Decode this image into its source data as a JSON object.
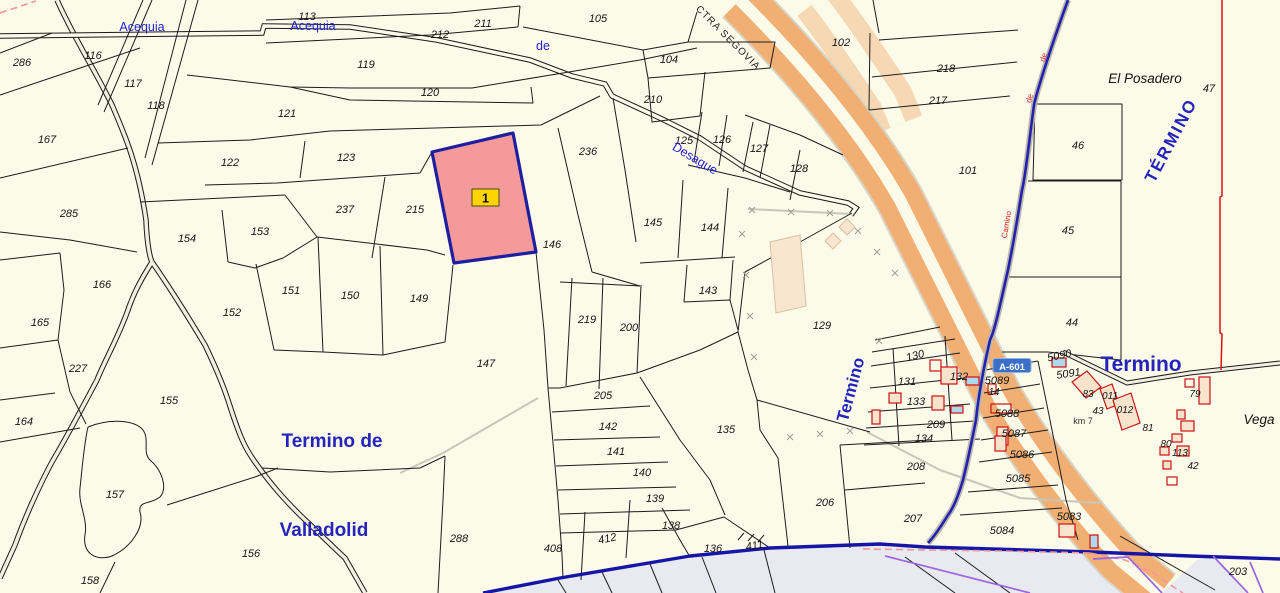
{
  "map": {
    "colors": {
      "background": "#FCFAE9",
      "highlight_fill": "#F59A9A",
      "highlight_border": "#1E1EA0",
      "badge_bg": "#FFD400",
      "highway_orange": "#F2AF74",
      "highway_ramp": "#F7D8B4",
      "canal_blue": "#2222AE",
      "boundary_blue": "#1616A6",
      "red_line": "#E01212",
      "purple_line": "#9A66E0",
      "pink_dash": "#F29898",
      "building_red": "#CC1111",
      "building_peach": "#F8E3CC",
      "building_blue": "#AFD8EC",
      "gray_area": "#E9EAF1"
    },
    "highlighted_parcel": {
      "badge": "1",
      "underlying_number": "214"
    },
    "road_shield": {
      "t": "A-601",
      "x": 1012,
      "y": 369
    },
    "parcel_numbers": [
      {
        "t": "286",
        "x": 22,
        "y": 62
      },
      {
        "t": "116",
        "x": 93,
        "y": 55
      },
      {
        "t": "117",
        "x": 133,
        "y": 83
      },
      {
        "t": "118",
        "x": 156,
        "y": 105
      },
      {
        "t": "167",
        "x": 47,
        "y": 139
      },
      {
        "t": "113",
        "x": 307,
        "y": 16
      },
      {
        "t": "211",
        "x": 483,
        "y": 23
      },
      {
        "t": "212",
        "x": 440,
        "y": 34
      },
      {
        "t": "105",
        "x": 598,
        "y": 18
      },
      {
        "t": "104",
        "x": 669,
        "y": 59
      },
      {
        "t": "210",
        "x": 653,
        "y": 99
      },
      {
        "t": "102",
        "x": 841,
        "y": 42
      },
      {
        "t": "218",
        "x": 946,
        "y": 68
      },
      {
        "t": "217",
        "x": 938,
        "y": 100
      },
      {
        "t": "101",
        "x": 968,
        "y": 170
      },
      {
        "t": "46",
        "x": 1078,
        "y": 145
      },
      {
        "t": "47",
        "x": 1209,
        "y": 88
      },
      {
        "t": "119",
        "x": 366,
        "y": 64
      },
      {
        "t": "120",
        "x": 430,
        "y": 92
      },
      {
        "t": "121",
        "x": 287,
        "y": 113
      },
      {
        "t": "122",
        "x": 230,
        "y": 162
      },
      {
        "t": "123",
        "x": 346,
        "y": 157
      },
      {
        "t": "237",
        "x": 345,
        "y": 209
      },
      {
        "t": "215",
        "x": 415,
        "y": 209
      },
      {
        "t": "236",
        "x": 588,
        "y": 151
      },
      {
        "t": "125",
        "x": 684,
        "y": 140
      },
      {
        "t": "126",
        "x": 722,
        "y": 139
      },
      {
        "t": "127",
        "x": 759,
        "y": 148
      },
      {
        "t": "128",
        "x": 799,
        "y": 168
      },
      {
        "t": "285",
        "x": 69,
        "y": 213
      },
      {
        "t": "154",
        "x": 187,
        "y": 238
      },
      {
        "t": "153",
        "x": 260,
        "y": 231
      },
      {
        "t": "145",
        "x": 653,
        "y": 222
      },
      {
        "t": "144",
        "x": 710,
        "y": 227
      },
      {
        "t": "146",
        "x": 552,
        "y": 244
      },
      {
        "t": "166",
        "x": 102,
        "y": 284
      },
      {
        "t": "165",
        "x": 40,
        "y": 322
      },
      {
        "t": "152",
        "x": 232,
        "y": 312
      },
      {
        "t": "151",
        "x": 291,
        "y": 290
      },
      {
        "t": "150",
        "x": 350,
        "y": 295
      },
      {
        "t": "149",
        "x": 419,
        "y": 298
      },
      {
        "t": "227",
        "x": 78,
        "y": 368
      },
      {
        "t": "219",
        "x": 587,
        "y": 319
      },
      {
        "t": "200",
        "x": 629,
        "y": 327
      },
      {
        "t": "143",
        "x": 708,
        "y": 290
      },
      {
        "t": "129",
        "x": 822,
        "y": 325
      },
      {
        "t": "45",
        "x": 1068,
        "y": 230
      },
      {
        "t": "44",
        "x": 1072,
        "y": 322
      },
      {
        "t": "147",
        "x": 486,
        "y": 363
      },
      {
        "t": "205",
        "x": 603,
        "y": 395
      },
      {
        "t": "142",
        "x": 608,
        "y": 426
      },
      {
        "t": "141",
        "x": 616,
        "y": 451
      },
      {
        "t": "140",
        "x": 642,
        "y": 472
      },
      {
        "t": "139",
        "x": 655,
        "y": 498
      },
      {
        "t": "138",
        "x": 671,
        "y": 525
      },
      {
        "t": "135",
        "x": 726,
        "y": 429
      },
      {
        "t": "130",
        "x": 916,
        "y": 355,
        "r": -15
      },
      {
        "t": "131",
        "x": 907,
        "y": 381
      },
      {
        "t": "132",
        "x": 959,
        "y": 376
      },
      {
        "t": "133",
        "x": 916,
        "y": 401
      },
      {
        "t": "209",
        "x": 936,
        "y": 424
      },
      {
        "t": "134",
        "x": 924,
        "y": 438
      },
      {
        "t": "208",
        "x": 916,
        "y": 466
      },
      {
        "t": "206",
        "x": 825,
        "y": 502
      },
      {
        "t": "207",
        "x": 913,
        "y": 518
      },
      {
        "t": "155",
        "x": 169,
        "y": 400
      },
      {
        "t": "164",
        "x": 24,
        "y": 421
      },
      {
        "t": "157",
        "x": 115,
        "y": 494
      },
      {
        "t": "156",
        "x": 251,
        "y": 553
      },
      {
        "t": "158",
        "x": 90,
        "y": 580
      },
      {
        "t": "288",
        "x": 459,
        "y": 538
      },
      {
        "t": "408",
        "x": 553,
        "y": 548
      },
      {
        "t": "412",
        "x": 608,
        "y": 538,
        "r": -12
      },
      {
        "t": "136",
        "x": 713,
        "y": 548
      },
      {
        "t": "411",
        "x": 755,
        "y": 545,
        "r": -10
      },
      {
        "t": "203",
        "x": 1238,
        "y": 571
      },
      {
        "t": "5089",
        "x": 997,
        "y": 380
      },
      {
        "t": "5088",
        "x": 1007,
        "y": 413
      },
      {
        "t": "5087",
        "x": 1014,
        "y": 433
      },
      {
        "t": "5086",
        "x": 1022,
        "y": 454
      },
      {
        "t": "5085",
        "x": 1018,
        "y": 478
      },
      {
        "t": "5084",
        "x": 1002,
        "y": 530
      },
      {
        "t": "5083",
        "x": 1069,
        "y": 516
      },
      {
        "t": "5090",
        "x": 1060,
        "y": 355,
        "r": -12
      },
      {
        "t": "5091",
        "x": 1069,
        "y": 373,
        "r": -8
      },
      {
        "t": "83",
        "x": 1088,
        "y": 393,
        "s": 1
      },
      {
        "t": "011",
        "x": 1110,
        "y": 395,
        "s": 1
      },
      {
        "t": "012",
        "x": 1125,
        "y": 409,
        "s": 1
      },
      {
        "t": "43",
        "x": 1098,
        "y": 410,
        "s": 1
      },
      {
        "t": "81",
        "x": 1148,
        "y": 427,
        "s": 1
      },
      {
        "t": "80",
        "x": 1166,
        "y": 443,
        "s": 1
      },
      {
        "t": "113",
        "x": 1180,
        "y": 452,
        "s": 1
      },
      {
        "t": "42",
        "x": 1193,
        "y": 465,
        "s": 1
      },
      {
        "t": "79",
        "x": 1195,
        "y": 393,
        "s": 1
      },
      {
        "t": "14",
        "x": 994,
        "y": 391,
        "s": 1
      }
    ],
    "hydro_labels": [
      {
        "t": "Acequia",
        "x": 142,
        "y": 26
      },
      {
        "t": "Acequia",
        "x": 313,
        "y": 25
      },
      {
        "t": "de",
        "x": 543,
        "y": 45
      },
      {
        "t": "Desague",
        "x": 693,
        "y": 157,
        "r": 31
      }
    ],
    "place_labels": [
      {
        "t": "Termino  de",
        "x": 332,
        "y": 441,
        "size": 19
      },
      {
        "t": "Valladolid",
        "x": 324,
        "y": 530,
        "size": 19
      },
      {
        "t": "Termino",
        "x": 856,
        "y": 385,
        "size": 17,
        "r": -75
      },
      {
        "t": "Termino",
        "x": 1141,
        "y": 365,
        "size": 21
      },
      {
        "t": "TÉRMINO",
        "x": 1176,
        "y": 137,
        "size": 17,
        "r": -62,
        "ls": 2
      }
    ],
    "placenames_black": [
      {
        "t": "El Posadero",
        "x": 1145,
        "y": 78
      },
      {
        "t": "Vega",
        "x": 1259,
        "y": 419
      }
    ],
    "road_labels": [
      {
        "t": "CTRA SEGOVIA",
        "x": 726,
        "y": 40,
        "r": 45
      }
    ],
    "km_label": {
      "t": "km 7",
      "x": 1083,
      "y": 420
    },
    "camino_labels": [
      {
        "t": "Camino",
        "x": 1009,
        "y": 225,
        "r": -80
      },
      {
        "t": "de",
        "x": 1032,
        "y": 99,
        "r": -75
      },
      {
        "t": "de",
        "x": 1046,
        "y": 58,
        "r": -75
      }
    ]
  }
}
